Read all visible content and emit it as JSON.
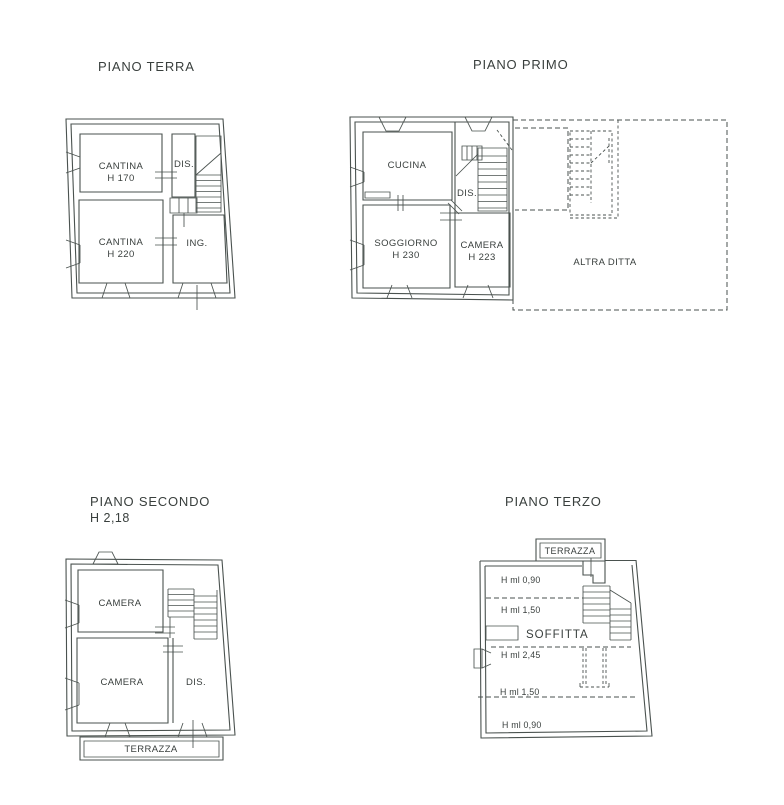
{
  "colors": {
    "background": "#ffffff",
    "line": "#4a524f",
    "text": "#393f3d"
  },
  "plans": {
    "terra": {
      "title": "PIANO TERRA",
      "rooms": {
        "cantina_top": "CANTINA",
        "cantina_top_height": "H 170",
        "dis": "DIS.",
        "cantina_bottom": "CANTINA",
        "cantina_bottom_height": "H 220",
        "ingresso": "ING."
      }
    },
    "primo": {
      "title": "PIANO PRIMO",
      "rooms": {
        "cucina": "CUCINA",
        "dis": "DIS.",
        "soggiorno": "SOGGIORNO",
        "soggiorno_height": "H 230",
        "camera": "CAMERA",
        "camera_height": "H 223",
        "altra_ditta": "ALTRA DITTA"
      }
    },
    "secondo": {
      "title": "PIANO SECONDO",
      "subtitle": "H 2,18",
      "rooms": {
        "camera_top": "CAMERA",
        "camera_bottom": "CAMERA",
        "dis": "DIS.",
        "terrazza": "TERRAZZA"
      }
    },
    "terzo": {
      "title": "PIANO TERZO",
      "rooms": {
        "terrazza": "TERRAZZA",
        "h_zone_1": "H ml 0,90",
        "h_zone_2": "H ml 1,50",
        "soffitta": "SOFFITTA",
        "h_zone_3": "H ml 2,45",
        "h_zone_4": "H ml 1,50",
        "h_zone_5": "H ml 0,90"
      }
    }
  }
}
